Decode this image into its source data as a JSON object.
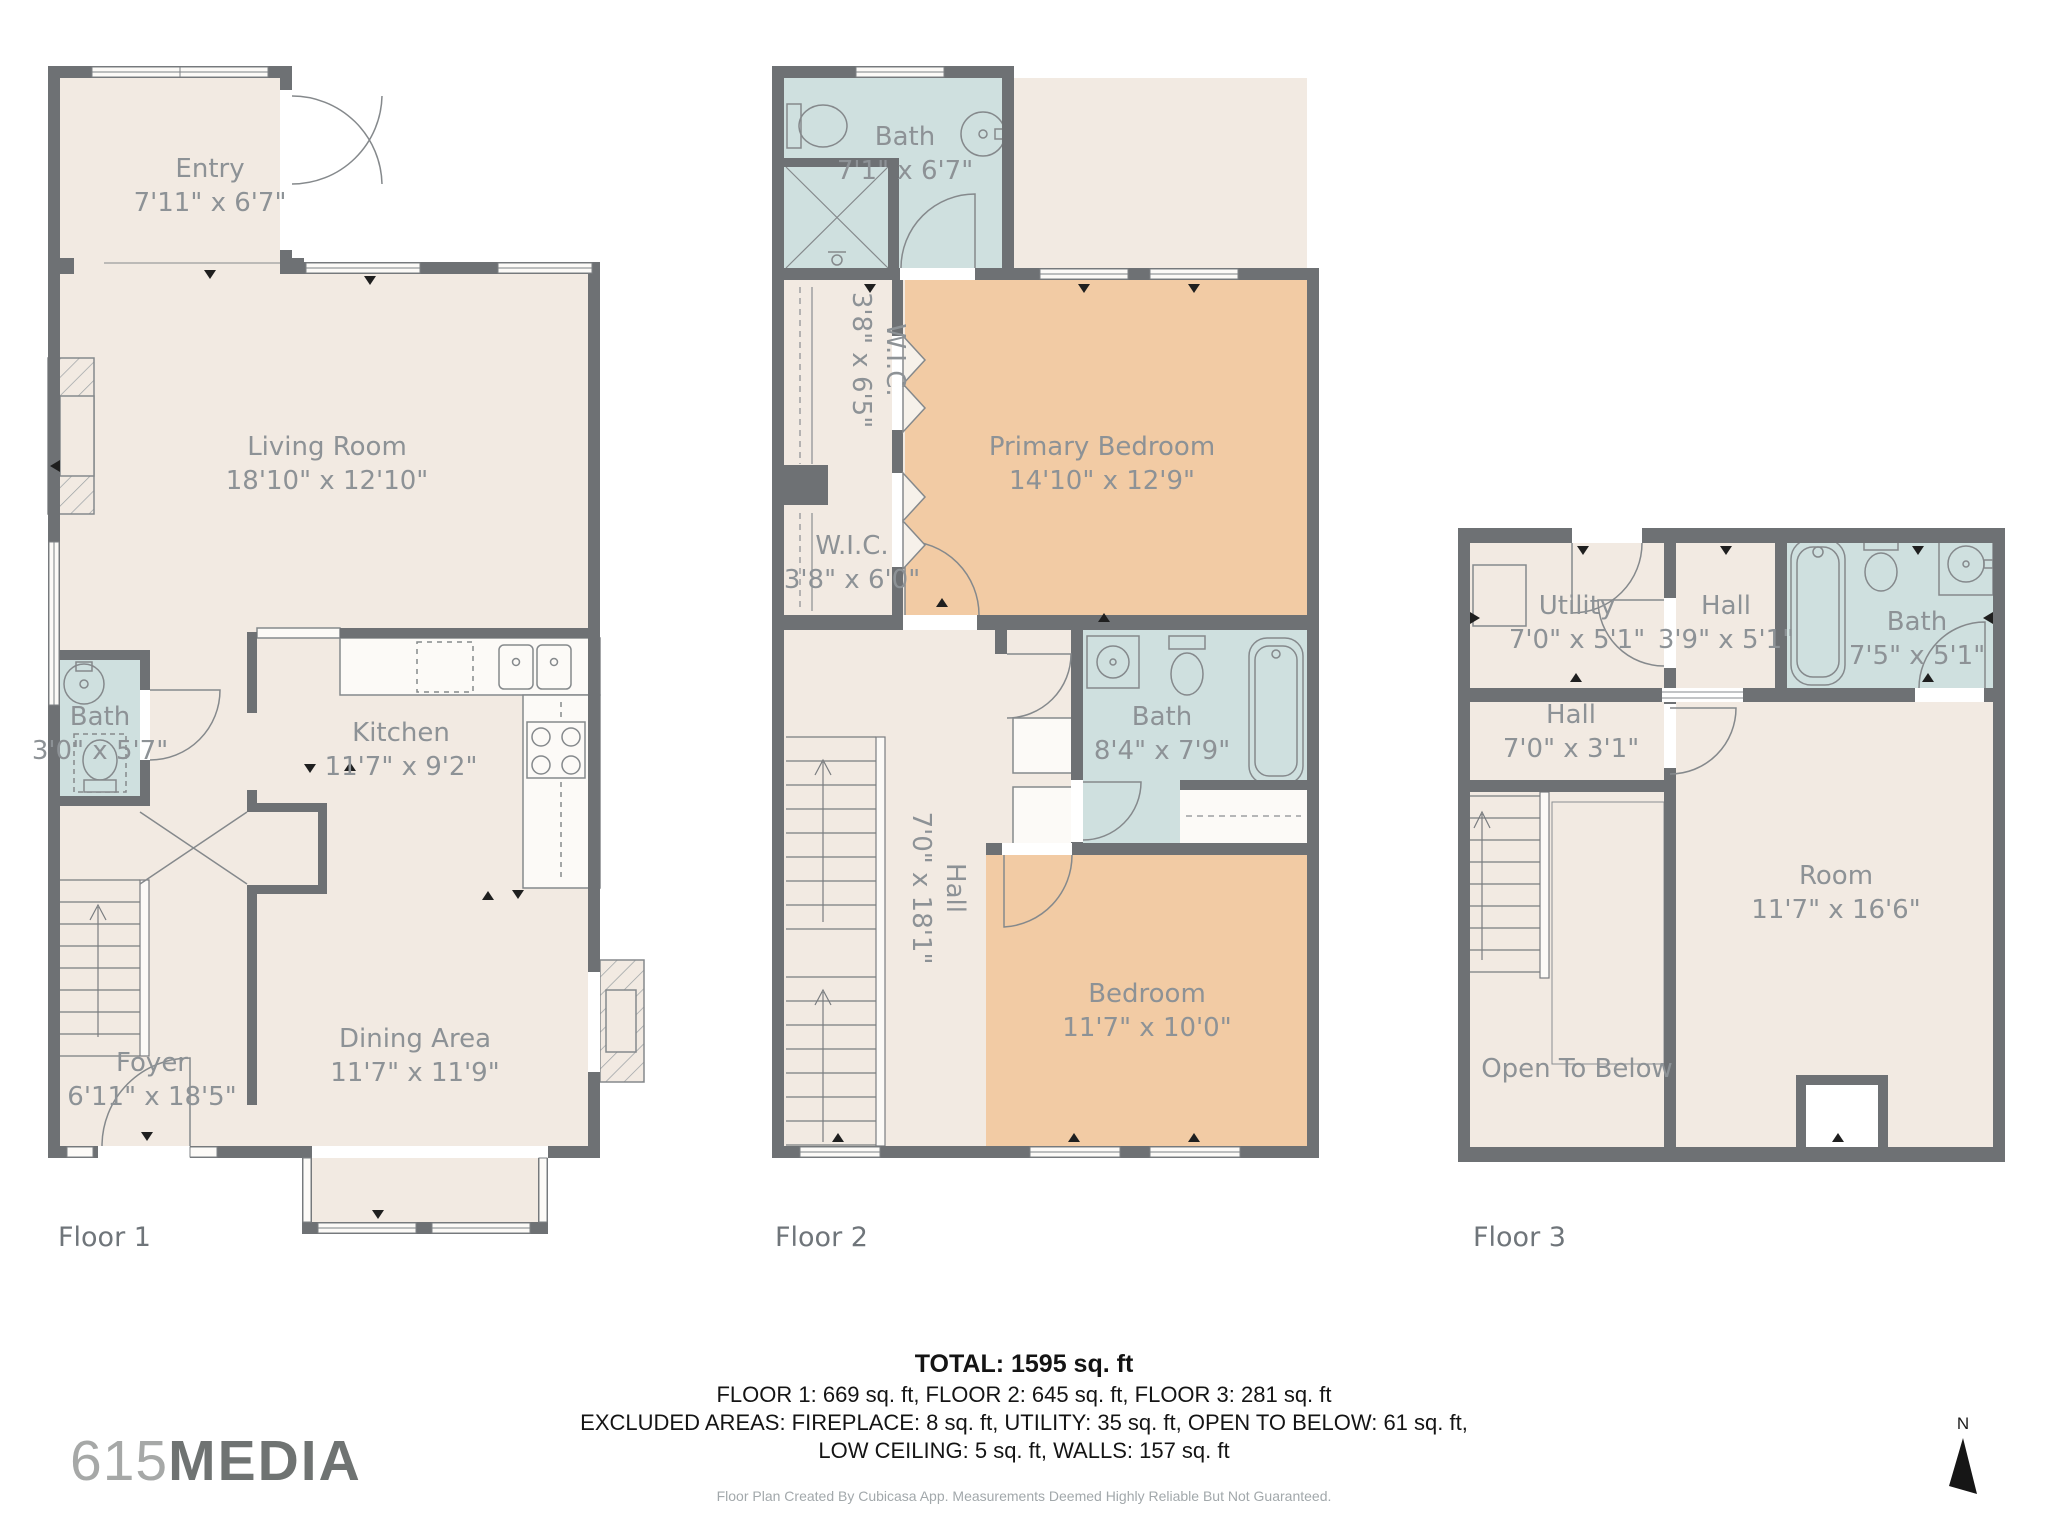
{
  "page": {
    "background": "#ffffff"
  },
  "branding": {
    "logo_prefix": "615",
    "logo_suffix": "MEDIA"
  },
  "compass": {
    "label": "N"
  },
  "floors": [
    {
      "label": "Floor 1",
      "rooms": [
        {
          "name": "Entry",
          "dims": "7'11\" x 6'7\""
        },
        {
          "name": "Living Room",
          "dims": "18'10\" x 12'10\""
        },
        {
          "name": "Bath",
          "dims": "3'0\" x 5'7\""
        },
        {
          "name": "Kitchen",
          "dims": "11'7\" x 9'2\""
        },
        {
          "name": "Foyer",
          "dims": "6'11\" x 18'5\""
        },
        {
          "name": "Dining Area",
          "dims": "11'7\" x 11'9\""
        }
      ]
    },
    {
      "label": "Floor 2",
      "rooms": [
        {
          "name": "Bath",
          "dims": "7'1\" x 6'7\""
        },
        {
          "name": "W.I.C.",
          "dims": "3'8\" x 6'5\""
        },
        {
          "name": "Primary Bedroom",
          "dims": "14'10\" x 12'9\""
        },
        {
          "name": "W.I.C.",
          "dims": "3'8\" x 6'0\""
        },
        {
          "name": "Hall",
          "dims": "7'0\" x 18'1\""
        },
        {
          "name": "Bath",
          "dims": "8'4\" x 7'9\""
        },
        {
          "name": "Bedroom",
          "dims": "11'7\" x 10'0\""
        }
      ]
    },
    {
      "label": "Floor 3",
      "rooms": [
        {
          "name": "Utility",
          "dims": "7'0\" x 5'1\""
        },
        {
          "name": "Hall",
          "dims": "3'9\" x 5'1\""
        },
        {
          "name": "Bath",
          "dims": "7'5\" x 5'1\""
        },
        {
          "name": "Hall",
          "dims": "7'0\" x 3'1\""
        },
        {
          "name": "Room",
          "dims": "11'7\" x 16'6\""
        },
        {
          "name": "Open To Below",
          "dims": ""
        }
      ]
    }
  ],
  "summary": {
    "total": "TOTAL: 1595 sq. ft",
    "floors_line": "FLOOR 1: 669 sq. ft, FLOOR 2: 645 sq. ft, FLOOR 3: 281 sq. ft",
    "excluded_line": "EXCLUDED AREAS: FIREPLACE: 8 sq. ft, UTILITY: 35 sq. ft, OPEN TO BELOW: 61 sq. ft,",
    "excluded_line2": "LOW CEILING: 5 sq. ft, WALLS: 157 sq. ft",
    "disclaimer": "Floor Plan Created By Cubicasa App. Measurements Deemed Highly Reliable But Not Guaranteed."
  },
  "colors": {
    "wall": "#6e7174",
    "room": "#f2eae2",
    "bath": "#cfe0df",
    "bedroom": "#f2cba4",
    "label": "#8d9296"
  }
}
